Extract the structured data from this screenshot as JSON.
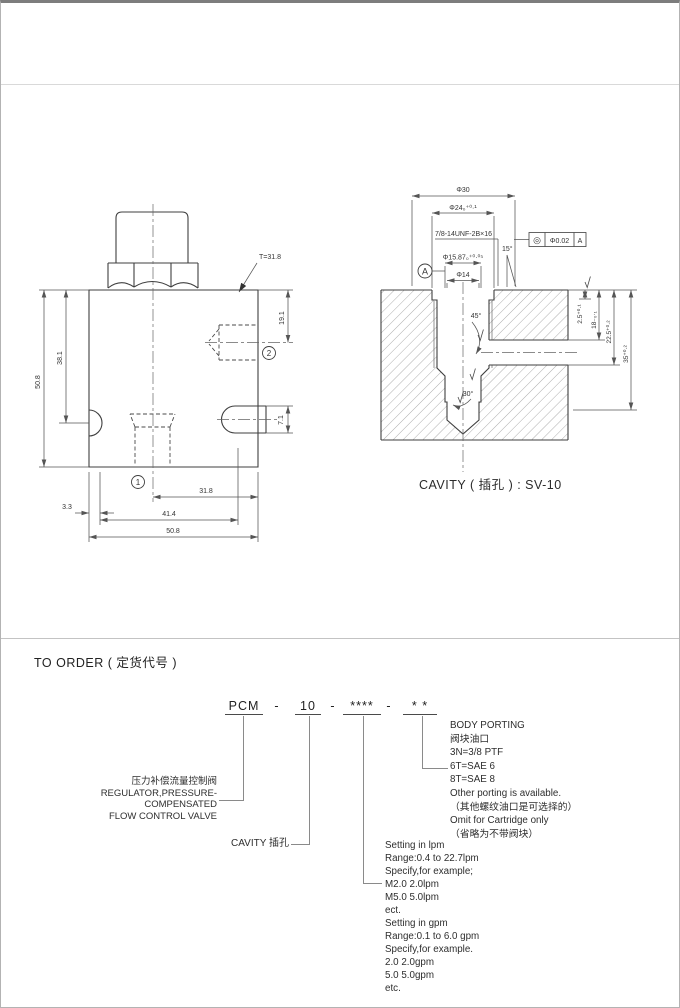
{
  "drawing_left": {
    "t_callout": "T=31.8",
    "dim_height_outer": "50.8",
    "dim_height_inner": "38.1",
    "dim_port2_depth": "19.1",
    "dim_slot_height": "7.1",
    "dim_step": "3.3",
    "dim_port1_x": "31.8",
    "dim_mid": "41.4",
    "dim_width": "50.8",
    "port1_label": "1",
    "port2_label": "2"
  },
  "drawing_cavity": {
    "dim_phi30": "Φ30",
    "dim_phi24": "Φ24₀⁺⁰·¹",
    "thread_callout": "7/8-14UNF-2B×16",
    "dim_phi15_87": "Φ15.87₀⁺⁰·⁰⁵",
    "dim_phi14": "Φ14",
    "angle_top": "15°",
    "angle_chamfer": "45°",
    "angle_bottom": "30°",
    "datum_label": "A",
    "fcf_symbol": "◎",
    "fcf_tolerance": "Φ0.02",
    "fcf_datum": "A",
    "dim_depth_counterbore": "2.5⁺⁰·¹",
    "dim_depth_18": "18₋₀·₁",
    "dim_depth_22_5": "22.5⁺⁰·²",
    "dim_depth_35": "35⁺⁰·²",
    "caption": "CAVITY ( 插孔 ) : SV-10"
  },
  "order": {
    "title": "TO ORDER ( 定货代号 )",
    "code_parts": [
      "PCM",
      "-",
      "10",
      "-",
      "****",
      "-",
      "*  *"
    ],
    "model_label_lines": [
      "压力补偿流量控制阀",
      "REGULATOR,PRESSURE-COMPENSATED",
      "FLOW CONTROL VALVE"
    ],
    "cavity_label": "CAVITY  插孔",
    "setting_lines": [
      "Setting in lpm",
      "Range:0.4 to 22.7lpm",
      "Specify,for example;",
      "M2.0  2.0lpm",
      "M5.0  5.0lpm",
      "ect.",
      "Setting in gpm",
      "Range:0.1 to 6.0 gpm",
      "Specify,for example.",
      "2.0   2.0gpm",
      "5.0   5.0gpm",
      "etc."
    ],
    "porting_lines": [
      "BODY PORTING",
      "阀块油口",
      "3N=3/8 PTF",
      "6T=SAE  6",
      "8T=SAE  8",
      "Other porting is available.",
      "（其他螺纹油口是可选择的）",
      "Omit for Cartridge only",
      "（省略为不带阀块）"
    ]
  },
  "colors": {
    "profile": "#3f3f3f",
    "dim": "#555555",
    "accent": "#8a8a8a"
  }
}
